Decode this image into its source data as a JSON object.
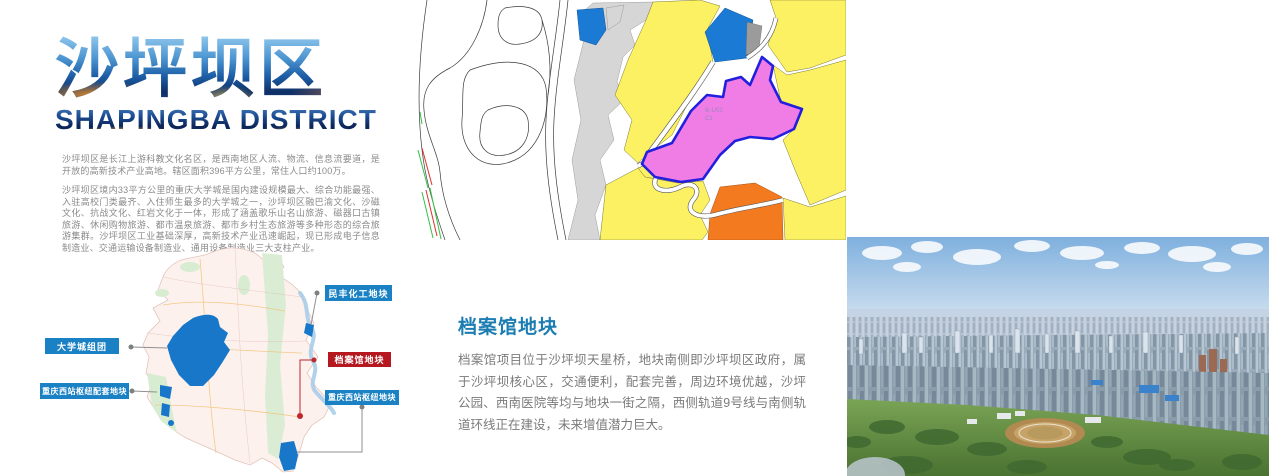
{
  "header": {
    "title_cn": "沙坪坝区",
    "title_en": "SHAPINGBA DISTRICT",
    "intro_p1": "沙坪坝区是长江上游科教文化名区，是西南地区人流、物流、信息流要道，是开放的高新技术产业高地。辖区面积396平方公里，常住人口约100万。",
    "intro_p2": "沙坪坝区境内33平方公里的重庆大学城是国内建设规模最大、综合功能最强、入驻高校门类最齐、入住师生最多的大学城之一，沙坪坝区融巴渝文化、沙磁文化、抗战文化、红岩文化于一体，形成了涵盖歌乐山名山旅游、磁器口古镇旅游、休闲购物旅游、都市温泉旅游、都市乡村生态旅游等多种形态的综合旅游集群。沙坪坝区工业基础深厚，高新技术产业迅速崛起，现已形成电子信息制造业、交通运输设备制造业、通用设备制造业三大支柱产业。"
  },
  "planning_map": {
    "parcel_code": "B-1/01",
    "parcel_subcode": "C1",
    "highlight_parcel_name": "档案馆地块",
    "colors": {
      "zone_yellow": "#FCF163",
      "parcel_blue": "#1B7AD4",
      "highlight_pink": "#F07DE6",
      "highlight_outline": "#2220DD",
      "industry_orange": "#F47A20",
      "buffer_gray": "#D6D6D6"
    }
  },
  "district_map": {
    "labels": [
      {
        "text": "民丰化工地块",
        "color": "#1A82C4"
      },
      {
        "text": "大学城组团",
        "color": "#1A82C4"
      },
      {
        "text": "档案馆地块",
        "color": "#B5191F"
      },
      {
        "text": "重庆西站枢纽配套地块",
        "color": "#1A82C4"
      },
      {
        "text": "重庆西站枢纽地块",
        "color": "#1A82C4"
      }
    ]
  },
  "archive_section": {
    "heading": "档案馆地块",
    "heading_color": "#1B7DB2",
    "body": "档案馆项目位于沙坪坝天星桥，地块南侧即沙坪坝区政府，属于沙坪坝核心区，交通便利，配套完善，周边环境优越，沙坪公园、西南医院等均与地块一街之隔，西侧轨道9号线与南侧轨道环线正在建设，未来增值潜力巨大。"
  }
}
